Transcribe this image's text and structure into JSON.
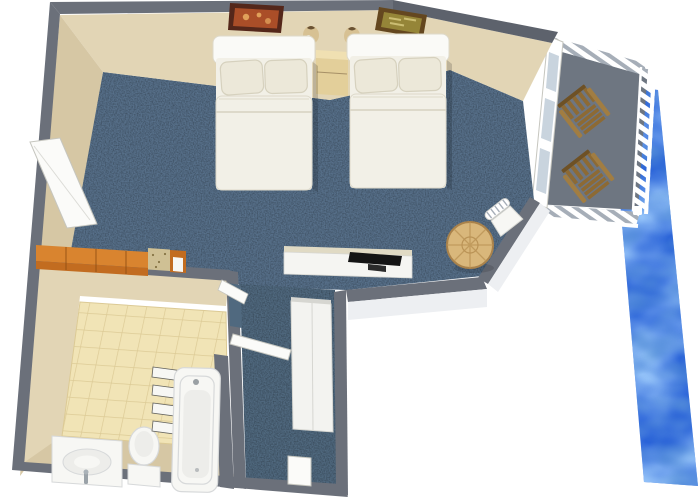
{
  "scene": {
    "type": "3d-floor-plan",
    "setting": "hotel-guest-room-with-waterfront-balcony",
    "background": "#ffffff"
  },
  "rooms": [
    "bedroom",
    "bathroom",
    "entry-hall",
    "balcony",
    "waterfront"
  ],
  "furniture": [
    "double-bed-1",
    "double-bed-2",
    "nightstand",
    "wall-lamp-1",
    "wall-lamp-2",
    "wall-picture-1",
    "wall-picture-2",
    "dresser",
    "stone-counter",
    "tv-desk",
    "flat-tv",
    "round-table",
    "side-chair",
    "deck-chair-1",
    "deck-chair-2",
    "closet",
    "entry-step",
    "bathroom-door",
    "connecting-door",
    "sliding-glass-door",
    "sink-vanity",
    "toilet",
    "bathtub",
    "towel-shelves"
  ],
  "colors": {
    "outside": "#ffffff",
    "wall_top": "#6b707a",
    "wall_top_dark": "#5d626c",
    "wall_face": "#e2d5b5",
    "wall_face_shade": "#d6c7a4",
    "wall_white_face": "#edeff2",
    "carpet": "#57708a",
    "carpet_dark": "#50697f",
    "tile": "#f1e4b6",
    "tile_line": "#dcca95",
    "water_base": "#2a63d8",
    "balcony_floor": "#6e7681",
    "rail_white": "#ffffff",
    "rail_shadow": "#a6aeb8",
    "glass": "#c9d4de",
    "door_white": "#fbfbf9",
    "door_edge": "#c6c6bf",
    "bed_linen": "#f2f0e7",
    "bed_shade": "#ddd9ca",
    "pillow": "#ece8d9",
    "pillow_edge": "#d6d1be",
    "headboard": "#fafaf7",
    "nightstand_top": "#f0e0b2",
    "nightstand": "#e3cf9a",
    "lamp": "#d7c193",
    "lamp_dark": "#6a5233",
    "pic1_frame": "#54271a",
    "pic1_art": "#aa4e28",
    "pic1_dot": "#e0a05a",
    "pic2_frame": "#64471f",
    "pic2_art": "#958538",
    "pic2_dot": "#cbbd72",
    "dresser_top": "#d9842f",
    "dresser_front": "#c26c20",
    "dresser_seam": "#8f4e13",
    "granite": "#cfc094",
    "granite_dot": "#867445",
    "desk": "#f5f5f2",
    "desk_back": "#e0dac4",
    "tv": "#141414",
    "tv_stand": "#2b2b2b",
    "table_wood": "#d9b77b",
    "table_line": "#ba9356",
    "table_rim": "#a9824b",
    "chair_wood": "#8d6a34",
    "chair_wood_dark": "#6e5125",
    "chair_wood_light": "#a17d42",
    "fixture": "#f7f7f4",
    "fixture_edge": "#d7d9da",
    "fixture_inner": "#ededea",
    "shelf_shadow": "#63635f",
    "closet": "#f3f3f0",
    "closet_edge": "#d6d6d1",
    "shadow": "#000000"
  }
}
